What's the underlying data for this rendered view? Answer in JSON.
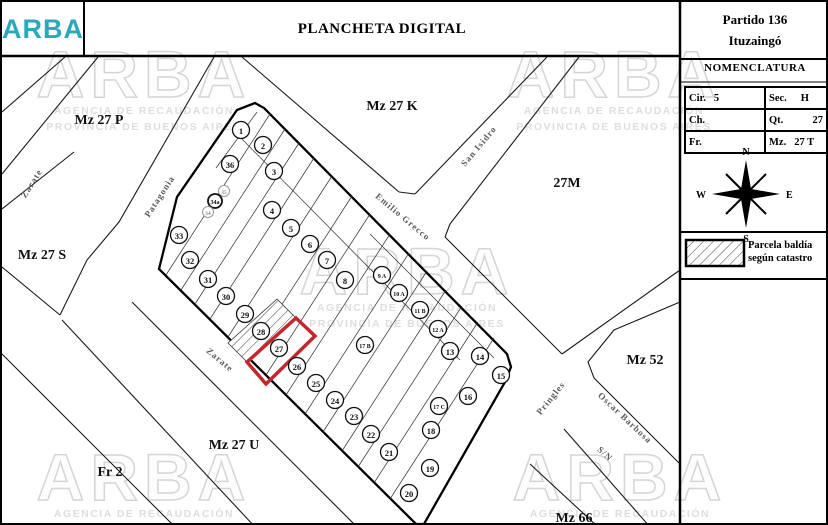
{
  "header": {
    "logo": "ARBA",
    "title": "PLANCHETA DIGITAL",
    "partido_line1": "Partido 136",
    "partido_line2": "Ituzaingó"
  },
  "nomenclatura": {
    "title": "NOMENCLATURA",
    "rows": [
      [
        {
          "k": "Cir.",
          "v": "5"
        },
        {
          "k": "Sec.",
          "v": "H"
        }
      ],
      [
        {
          "k": "Ch.",
          "v": ""
        },
        {
          "k": "Qt.",
          "v": "27"
        }
      ],
      [
        {
          "k": "Fr.",
          "v": ""
        },
        {
          "k": "Mz.",
          "v": "27 T"
        }
      ]
    ]
  },
  "compass": {
    "n": "N",
    "s": "S",
    "e": "E",
    "w": "W"
  },
  "legend": {
    "line1": "Parcela baldía",
    "line2": "según catastro"
  },
  "watermark": {
    "word": "ARBA",
    "sub1": "AGENCIA DE RECAUDACIÓN",
    "sub2": "PROVINCIA DE BUENOS AIRES",
    "positions": [
      [
        142,
        95
      ],
      [
        612,
        95
      ],
      [
        405,
        292
      ],
      [
        142,
        498
      ],
      [
        618,
        498
      ]
    ]
  },
  "map": {
    "block_outline": "235,108 253,101 262,106 505,352 509,365 503,380 422,522 414,522 157,267 175,195",
    "red_parcel": "294,316 313,334 264,382 245,360",
    "vacant_parcel": "275,297 294,316 245,360 226,341",
    "streets": [
      [
        63,
        55,
        0,
        110
      ],
      [
        96,
        55,
        0,
        172
      ],
      [
        212,
        55,
        117,
        220,
        85,
        258,
        58,
        313
      ],
      [
        72,
        150,
        0,
        207
      ],
      [
        0,
        265,
        58,
        313
      ],
      [
        60,
        318,
        253,
        525
      ],
      [
        0,
        352,
        173,
        525
      ],
      [
        130,
        300,
        355,
        525
      ],
      [
        240,
        55,
        397,
        190
      ],
      [
        397,
        190,
        413,
        192
      ],
      [
        413,
        192,
        545,
        55
      ],
      [
        577,
        55,
        448,
        222
      ],
      [
        448,
        222,
        443,
        235
      ],
      [
        443,
        235,
        560,
        352
      ],
      [
        678,
        268,
        560,
        352
      ],
      [
        678,
        300,
        612,
        328,
        586,
        360,
        592,
        376,
        678,
        462
      ],
      [
        562,
        427,
        648,
        525
      ],
      [
        528,
        462,
        596,
        525
      ]
    ],
    "lot_lines": [
      [
        255,
        110,
        214,
        166
      ],
      [
        268,
        112,
        164,
        273
      ],
      [
        283,
        127,
        179,
        288
      ],
      [
        297,
        141,
        193,
        302
      ],
      [
        312,
        156,
        208,
        317
      ],
      [
        330,
        174,
        226,
        335
      ],
      [
        350,
        194,
        246,
        355
      ],
      [
        368,
        212,
        264,
        373
      ],
      [
        388,
        232,
        284,
        393
      ],
      [
        407,
        251,
        303,
        412
      ],
      [
        425,
        269,
        321,
        430
      ],
      [
        444,
        288,
        340,
        449
      ],
      [
        460,
        304,
        356,
        465
      ],
      [
        476,
        320,
        372,
        481
      ],
      [
        492,
        336,
        388,
        497
      ],
      [
        233,
        130,
        458,
        358
      ],
      [
        368,
        232,
        492,
        356
      ]
    ],
    "parcels": [
      [
        "1",
        239,
        128,
        "n"
      ],
      [
        "2",
        261,
        143,
        "n"
      ],
      [
        "3",
        272,
        169,
        "n"
      ],
      [
        "4",
        270,
        208,
        "n"
      ],
      [
        "5",
        289,
        226,
        "n"
      ],
      [
        "6",
        308,
        242,
        "n"
      ],
      [
        "7",
        325,
        258,
        "n"
      ],
      [
        "8",
        343,
        278,
        "n"
      ],
      [
        "9 A",
        380,
        273,
        "n"
      ],
      [
        "10 A",
        397,
        291,
        "n"
      ],
      [
        "11 B",
        418,
        308,
        "n"
      ],
      [
        "12 A",
        436,
        327,
        "n"
      ],
      [
        "13",
        448,
        349,
        "n"
      ],
      [
        "14",
        478,
        354,
        "n"
      ],
      [
        "15",
        499,
        373,
        "n"
      ],
      [
        "16",
        466,
        394,
        "n"
      ],
      [
        "17 C",
        437,
        404,
        "n"
      ],
      [
        "17 B",
        363,
        343,
        "n"
      ],
      [
        "18",
        429,
        428,
        "n"
      ],
      [
        "19",
        428,
        466,
        "n"
      ],
      [
        "20",
        407,
        491,
        "n"
      ],
      [
        "21",
        387,
        450,
        "n"
      ],
      [
        "22",
        369,
        432,
        "n"
      ],
      [
        "23",
        352,
        414,
        "n"
      ],
      [
        "24",
        333,
        398,
        "n"
      ],
      [
        "25",
        314,
        381,
        "n"
      ],
      [
        "26",
        295,
        364,
        "n"
      ],
      [
        "27",
        277,
        346,
        "n"
      ],
      [
        "28",
        259,
        329,
        "n"
      ],
      [
        "29",
        243,
        312,
        "n"
      ],
      [
        "30",
        224,
        294,
        "n"
      ],
      [
        "31",
        206,
        277,
        "n"
      ],
      [
        "32",
        188,
        258,
        "n"
      ],
      [
        "33",
        177,
        233,
        "n"
      ],
      [
        "36",
        228,
        162,
        "n"
      ],
      [
        "35",
        222,
        189,
        "s"
      ],
      [
        "34a",
        213,
        199,
        "b"
      ],
      [
        "34",
        206,
        210,
        "s"
      ]
    ],
    "street_labels": [
      [
        "Zarate",
        32,
        183,
        -58
      ],
      [
        "Patagonia",
        160,
        196,
        -57
      ],
      [
        "Emilio Grecco",
        399,
        217,
        40
      ],
      [
        "San Isidro",
        479,
        146,
        -50
      ],
      [
        "Zarate",
        216,
        360,
        40
      ],
      [
        "Pringles",
        551,
        398,
        -51
      ],
      [
        "Oscar Barbosa",
        621,
        418,
        43
      ],
      [
        "S/N",
        601,
        454,
        43
      ]
    ],
    "block_labels": [
      [
        "Mz 27 P",
        97,
        122
      ],
      [
        "Mz 27 K",
        390,
        108
      ],
      [
        "27M",
        565,
        185
      ],
      [
        "Mz 27 S",
        40,
        257
      ],
      [
        "Mz 52",
        643,
        362
      ],
      [
        "Mz 27 U",
        232,
        447
      ],
      [
        "Fr 2",
        108,
        474
      ],
      [
        "Mz 66",
        572,
        520
      ]
    ]
  }
}
